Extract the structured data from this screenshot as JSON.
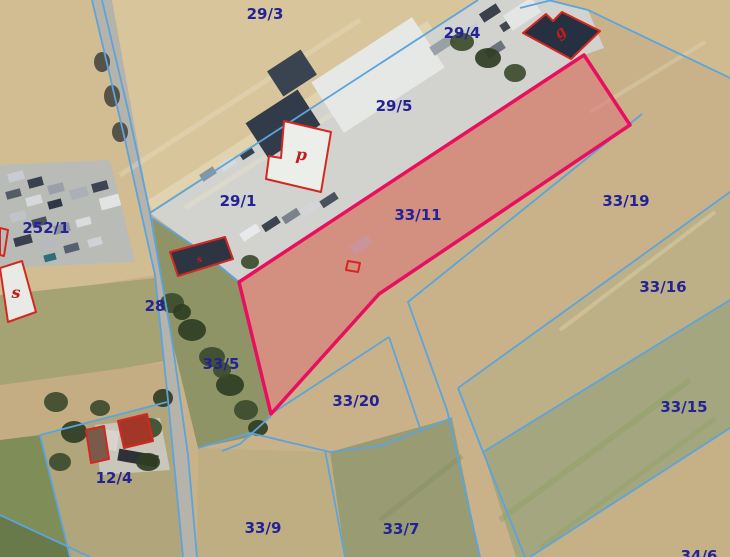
{
  "map": {
    "colors": {
      "base_field": "#c9b28a",
      "boundary_line": "#5ca4db",
      "parcel_label": "#232394",
      "highlight_stroke": "#e8105e",
      "highlight_fill": "#dd6b76",
      "building_outline": "#d32822",
      "building_letter": "#c21d1d",
      "road": "#b5b3aa",
      "yard": "#d2d3cf"
    },
    "highlight_parcel": {
      "id": "33/11",
      "points": "584,55 630,125 379,294 271,414 239,282",
      "fill_opacity": 0.5
    },
    "fields": [
      {
        "name": "field-29-3",
        "fill": "#d8c59c",
        "points": "92,0 478,0 150,213 122,130"
      },
      {
        "name": "field-left-top",
        "fill": "#d2bd93",
        "points": "0,0 92,0 125,140 155,275 0,300"
      },
      {
        "name": "grass-left-mid",
        "fill": "#a5a274",
        "points": "0,295 155,278 170,360 0,390"
      },
      {
        "name": "field-left-lower",
        "fill": "#c4ad83",
        "points": "0,385 170,362 172,400 40,435 0,445"
      },
      {
        "name": "green-bottom-left",
        "fill": "#7f8d58",
        "points": "0,440 40,435 72,557 0,557"
      },
      {
        "name": "green-corner-dark",
        "fill": "#68794a",
        "points": "0,515 90,557 0,557"
      },
      {
        "name": "parcel-12-4-ground",
        "fill": "#b0a57b",
        "points": "40,435 167,402 183,557 70,557"
      },
      {
        "name": "courtyard-12-4",
        "fill": "#c9c6bb",
        "points": "95,425 160,418 170,470 100,475"
      },
      {
        "name": "parking-ground",
        "fill": "#b9bbb7",
        "points": "0,165 110,160 135,262 0,268"
      },
      {
        "name": "industrial-yard",
        "fill": "#d2d3cf",
        "points": "150,213 478,0 548,0 588,10 604,48 584,55 239,282 200,250"
      },
      {
        "name": "field-ne-of-yard",
        "fill": "#d0ba90",
        "points": "548,0 730,0 730,78 588,10"
      },
      {
        "name": "strip-33-16",
        "fill": "#bdb086",
        "points": "458,388 730,192 730,300 483,452"
      },
      {
        "name": "strip-33-15",
        "fill": "#a3a67f",
        "points": "483,452 730,300 730,428 530,557 516,557"
      },
      {
        "name": "corner-34-6",
        "fill": "#c6b086",
        "points": "530,557 730,428 730,557"
      },
      {
        "name": "field-33-7",
        "fill": "#999b72",
        "points": "330,452 452,418 480,557 345,557"
      },
      {
        "name": "field-33-9",
        "fill": "#c0ae83",
        "points": "198,448 330,452 345,557 197,557"
      },
      {
        "name": "trees-wedge-33-5",
        "fill": "#8e9465",
        "points": "152,218 200,250 239,282 271,414 250,437 198,448 172,340"
      },
      {
        "name": "road",
        "fill": "#b5b3aa",
        "points": "92,0 112,0 150,213 172,340 188,455 197,557 183,557 168,400 155,275 125,140"
      }
    ],
    "streaks": [
      {
        "x1": 150,
        "y1": 205,
        "x2": 430,
        "y2": 25,
        "w": 10,
        "c": "#ece1c4",
        "o": 0.5
      },
      {
        "x1": 185,
        "y1": 208,
        "x2": 448,
        "y2": 40,
        "w": 5,
        "c": "#ece1c4",
        "o": 0.4
      },
      {
        "x1": 120,
        "y1": 175,
        "x2": 360,
        "y2": 20,
        "w": 5,
        "c": "#ece1c4",
        "o": 0.35
      },
      {
        "x1": 560,
        "y1": 330,
        "x2": 715,
        "y2": 212,
        "w": 4,
        "c": "#e9dfc4",
        "o": 0.35
      },
      {
        "x1": 590,
        "y1": 112,
        "x2": 705,
        "y2": 42,
        "w": 4,
        "c": "#e9dfc4",
        "o": 0.3
      },
      {
        "x1": 500,
        "y1": 520,
        "x2": 690,
        "y2": 380,
        "w": 6,
        "c": "#93a468",
        "o": 0.55
      },
      {
        "x1": 540,
        "y1": 548,
        "x2": 716,
        "y2": 418,
        "w": 5,
        "c": "#93a468",
        "o": 0.45
      },
      {
        "x1": 380,
        "y1": 520,
        "x2": 462,
        "y2": 456,
        "w": 5,
        "c": "#7f8f5f",
        "o": 0.4
      }
    ],
    "clutter": [
      {
        "x": 318,
        "y": 45,
        "w": 120,
        "h": 60,
        "rot": -33,
        "fill": "#e6e8e5"
      },
      {
        "x": 252,
        "y": 103,
        "w": 62,
        "h": 42,
        "rot": -33,
        "fill": "#323b49"
      },
      {
        "x": 272,
        "y": 58,
        "w": 40,
        "h": 30,
        "rot": -33,
        "fill": "#3a4350"
      },
      {
        "x": 430,
        "y": 40,
        "w": 24,
        "h": 10,
        "rot": -33,
        "fill": "#9aa0a7"
      },
      {
        "x": 458,
        "y": 28,
        "w": 22,
        "h": 9,
        "rot": -33,
        "fill": "#c7cbce"
      },
      {
        "x": 485,
        "y": 45,
        "w": 20,
        "h": 9,
        "rot": -33,
        "fill": "#6c737d"
      },
      {
        "x": 500,
        "y": 20,
        "w": 18,
        "h": 8,
        "rot": -33,
        "fill": "#40474f"
      },
      {
        "x": 505,
        "y": 5,
        "w": 34,
        "h": 18,
        "rot": -33,
        "fill": "#e4e6e3"
      },
      {
        "x": 480,
        "y": 8,
        "w": 20,
        "h": 10,
        "rot": -33,
        "fill": "#3a414b"
      },
      {
        "x": 240,
        "y": 228,
        "w": 20,
        "h": 9,
        "rot": -33,
        "fill": "#e8e9ea"
      },
      {
        "x": 262,
        "y": 220,
        "w": 18,
        "h": 8,
        "rot": -33,
        "fill": "#3c4450"
      },
      {
        "x": 282,
        "y": 212,
        "w": 18,
        "h": 8,
        "rot": -33,
        "fill": "#7b828c"
      },
      {
        "x": 300,
        "y": 204,
        "w": 20,
        "h": 9,
        "rot": -33,
        "fill": "#d2d4d6"
      },
      {
        "x": 320,
        "y": 196,
        "w": 18,
        "h": 8,
        "rot": -33,
        "fill": "#4a525e"
      },
      {
        "x": 350,
        "y": 240,
        "w": 22,
        "h": 10,
        "rot": -33,
        "fill": "#b8bcc1"
      },
      {
        "x": 200,
        "y": 170,
        "w": 16,
        "h": 8,
        "rot": -33,
        "fill": "#8c939b"
      },
      {
        "x": 220,
        "y": 160,
        "w": 16,
        "h": 8,
        "rot": -33,
        "fill": "#d8dadb"
      },
      {
        "x": 240,
        "y": 150,
        "w": 14,
        "h": 7,
        "rot": -33,
        "fill": "#39414e"
      },
      {
        "x": 8,
        "y": 172,
        "w": 16,
        "h": 9,
        "rot": -15,
        "fill": "#c8ccd2"
      },
      {
        "x": 28,
        "y": 178,
        "w": 15,
        "h": 9,
        "rot": -15,
        "fill": "#39414f"
      },
      {
        "x": 48,
        "y": 184,
        "w": 16,
        "h": 9,
        "rot": -15,
        "fill": "#9aa0a8"
      },
      {
        "x": 6,
        "y": 190,
        "w": 15,
        "h": 8,
        "rot": -15,
        "fill": "#545c68"
      },
      {
        "x": 26,
        "y": 196,
        "w": 16,
        "h": 9,
        "rot": -15,
        "fill": "#d6d8da"
      },
      {
        "x": 48,
        "y": 200,
        "w": 14,
        "h": 8,
        "rot": -15,
        "fill": "#2f3744"
      },
      {
        "x": 70,
        "y": 188,
        "w": 18,
        "h": 10,
        "rot": -15,
        "fill": "#aab0b6"
      },
      {
        "x": 92,
        "y": 182,
        "w": 16,
        "h": 9,
        "rot": -15,
        "fill": "#3d4553"
      },
      {
        "x": 100,
        "y": 196,
        "w": 20,
        "h": 12,
        "rot": -15,
        "fill": "#e2e4e3"
      },
      {
        "x": 10,
        "y": 212,
        "w": 16,
        "h": 9,
        "rot": -15,
        "fill": "#c0c4ca"
      },
      {
        "x": 32,
        "y": 218,
        "w": 15,
        "h": 8,
        "rot": -15,
        "fill": "#4a5260"
      },
      {
        "x": 54,
        "y": 224,
        "w": 16,
        "h": 9,
        "rot": -15,
        "fill": "#8d939c"
      },
      {
        "x": 76,
        "y": 218,
        "w": 15,
        "h": 8,
        "rot": -15,
        "fill": "#d9dbdd"
      },
      {
        "x": 14,
        "y": 236,
        "w": 18,
        "h": 9,
        "rot": -15,
        "fill": "#39404d"
      },
      {
        "x": 40,
        "y": 240,
        "w": 16,
        "h": 8,
        "rot": -15,
        "fill": "#b6bac0"
      },
      {
        "x": 64,
        "y": 244,
        "w": 15,
        "h": 8,
        "rot": -15,
        "fill": "#566070"
      },
      {
        "x": 88,
        "y": 238,
        "w": 14,
        "h": 8,
        "rot": -15,
        "fill": "#cfd2d6"
      },
      {
        "x": 44,
        "y": 254,
        "w": 12,
        "h": 7,
        "rot": -15,
        "fill": "#2e6f7a"
      },
      {
        "x": 118,
        "y": 452,
        "w": 40,
        "h": 12,
        "rot": 10,
        "fill": "#2e3138"
      },
      {
        "x": 100,
        "y": 430,
        "w": 18,
        "h": 20,
        "rot": 8,
        "fill": "#d8d4cc"
      }
    ],
    "trees": [
      {
        "cx": 172,
        "cy": 303,
        "rx": 12,
        "ry": 10,
        "fill": "#3c4b2c"
      },
      {
        "cx": 192,
        "cy": 330,
        "rx": 14,
        "ry": 11,
        "fill": "#2f3d23"
      },
      {
        "cx": 212,
        "cy": 357,
        "rx": 13,
        "ry": 10,
        "fill": "#3c4b2c"
      },
      {
        "cx": 230,
        "cy": 385,
        "rx": 14,
        "ry": 11,
        "fill": "#2f3d23"
      },
      {
        "cx": 246,
        "cy": 410,
        "rx": 12,
        "ry": 10,
        "fill": "#3c4b2c"
      },
      {
        "cx": 258,
        "cy": 428,
        "rx": 10,
        "ry": 8,
        "fill": "#2f3d23"
      },
      {
        "cx": 182,
        "cy": 312,
        "rx": 9,
        "ry": 8,
        "fill": "#2f3d23"
      },
      {
        "cx": 222,
        "cy": 370,
        "rx": 9,
        "ry": 8,
        "fill": "#3c4b2c"
      },
      {
        "cx": 250,
        "cy": 262,
        "rx": 9,
        "ry": 7,
        "fill": "#3c4b2c"
      },
      {
        "cx": 56,
        "cy": 402,
        "rx": 12,
        "ry": 10,
        "fill": "#3c4b2c"
      },
      {
        "cx": 74,
        "cy": 432,
        "rx": 13,
        "ry": 11,
        "fill": "#2f3d23"
      },
      {
        "cx": 150,
        "cy": 428,
        "rx": 12,
        "ry": 10,
        "fill": "#3c4b2c"
      },
      {
        "cx": 163,
        "cy": 398,
        "rx": 10,
        "ry": 9,
        "fill": "#2f3d23"
      },
      {
        "cx": 60,
        "cy": 462,
        "rx": 11,
        "ry": 9,
        "fill": "#3c4b2c"
      },
      {
        "cx": 148,
        "cy": 462,
        "rx": 12,
        "ry": 9,
        "fill": "#2f3d23"
      },
      {
        "cx": 100,
        "cy": 408,
        "rx": 10,
        "ry": 8,
        "fill": "#3c4b2c"
      },
      {
        "cx": 462,
        "cy": 42,
        "rx": 12,
        "ry": 9,
        "fill": "#3c4b2c"
      },
      {
        "cx": 488,
        "cy": 58,
        "rx": 13,
        "ry": 10,
        "fill": "#2f3d23"
      },
      {
        "cx": 515,
        "cy": 73,
        "rx": 11,
        "ry": 9,
        "fill": "#3c4b2c"
      },
      {
        "cx": 102,
        "cy": 62,
        "rx": 8,
        "ry": 10,
        "fill": "#4a4a40"
      },
      {
        "cx": 112,
        "cy": 96,
        "rx": 8,
        "ry": 11,
        "fill": "#4a4a40"
      },
      {
        "cx": 120,
        "cy": 132,
        "rx": 8,
        "ry": 10,
        "fill": "#4a4a40"
      }
    ],
    "boundary_lines": [
      {
        "name": "road-west-edge",
        "points": "92,0 125,140 155,275 168,400 183,557"
      },
      {
        "name": "road-east-lower",
        "points": "150,213 172,340 188,455 197,557"
      },
      {
        "name": "road-east-upper",
        "points": "102,0 128,110 150,213"
      },
      {
        "name": "yard-nw-boundary",
        "points": "478,0 150,213"
      },
      {
        "name": "boundary-top-right",
        "points": "548,0 588,10 730,78"
      },
      {
        "name": "seg-top-corner",
        "points": "520,8 552,0"
      },
      {
        "name": "boundary-33-19-se",
        "points": "642,114 408,302 447,410 480,557"
      },
      {
        "name": "boundary-33-16-nw",
        "points": "458,388 730,192"
      },
      {
        "name": "boundary-33-16-w",
        "points": "458,388 483,452 525,557"
      },
      {
        "name": "boundary-33-15-nw",
        "points": "483,452 730,300"
      },
      {
        "name": "boundary-34-6-nw",
        "points": "530,557 730,428"
      },
      {
        "name": "boundary-33-20-n",
        "points": "271,414 389,337"
      },
      {
        "name": "boundary-33-20-e",
        "points": "389,337 420,428"
      },
      {
        "name": "boundary-33-20-s",
        "points": "198,448 250,433 330,452 380,446 452,418"
      },
      {
        "name": "boundary-33-9-e",
        "points": "325,450 345,557"
      },
      {
        "name": "boundary-33-5-s",
        "points": "271,416 240,444 222,451"
      },
      {
        "name": "yard-south-edge",
        "points": "152,218 200,250 239,282"
      },
      {
        "name": "parcel-12-4-edge",
        "points": "167,402 40,435 70,557"
      },
      {
        "name": "corner-bottom-left",
        "points": "0,515 90,557"
      }
    ],
    "buildings": [
      {
        "name": "building-s-large",
        "points": "0,268 22,261 36,312 8,322",
        "fill": "#e9eae6",
        "letter": "s",
        "lx": 16,
        "ly": 298,
        "lsize": 16,
        "lrot": 0
      },
      {
        "name": "building-edge-partial",
        "points": "0,228 8,230 4,256 0,255",
        "fill": "none"
      },
      {
        "name": "building-shed-row",
        "points": "170,252 225,237 233,259 178,276",
        "fill": "#2d3542",
        "letter": "s",
        "lx": 200,
        "ly": 262,
        "lsize": 9,
        "lrot": -10
      },
      {
        "name": "building-tiny-marker",
        "points": "348,261 360,263 358,272 346,270",
        "fill": "none"
      },
      {
        "name": "building-p",
        "points": "284,121 331,132 321,192 266,179 269,156 281,158",
        "fill": "#eceee9",
        "letter": "p",
        "lx": 301,
        "ly": 160,
        "lsize": 16,
        "lrot": 5
      },
      {
        "name": "building-g",
        "points": "523,33 546,14 553,21 562,12 600,31 571,59",
        "fill": "#273040",
        "letter": "g",
        "lx": 563,
        "ly": 36,
        "lsize": 15,
        "lrot": -40
      },
      {
        "name": "building-farm-a",
        "points": "86,430 104,426 109,459 91,463",
        "fill": "#7a5a48"
      },
      {
        "name": "building-farm-b",
        "points": "118,421 147,414 153,441 124,448",
        "fill": "#a23627"
      }
    ],
    "labels": [
      {
        "id": "29/3",
        "x": 265,
        "y": 19
      },
      {
        "id": "29/4",
        "x": 462,
        "y": 38
      },
      {
        "id": "29/5",
        "x": 394,
        "y": 111
      },
      {
        "id": "29/1",
        "x": 238,
        "y": 206
      },
      {
        "id": "252/1",
        "x": 46,
        "y": 233
      },
      {
        "id": "33/11",
        "x": 418,
        "y": 220
      },
      {
        "id": "33/19",
        "x": 626,
        "y": 206
      },
      {
        "id": "33/16",
        "x": 663,
        "y": 292
      },
      {
        "id": "28",
        "x": 155,
        "y": 311
      },
      {
        "id": "33/5",
        "x": 221,
        "y": 369
      },
      {
        "id": "33/20",
        "x": 356,
        "y": 406
      },
      {
        "id": "33/15",
        "x": 684,
        "y": 412
      },
      {
        "id": "12/4",
        "x": 114,
        "y": 483
      },
      {
        "id": "33/9",
        "x": 263,
        "y": 533
      },
      {
        "id": "33/7",
        "x": 401,
        "y": 534
      },
      {
        "id": "34/6",
        "x": 699,
        "y": 561
      }
    ]
  }
}
